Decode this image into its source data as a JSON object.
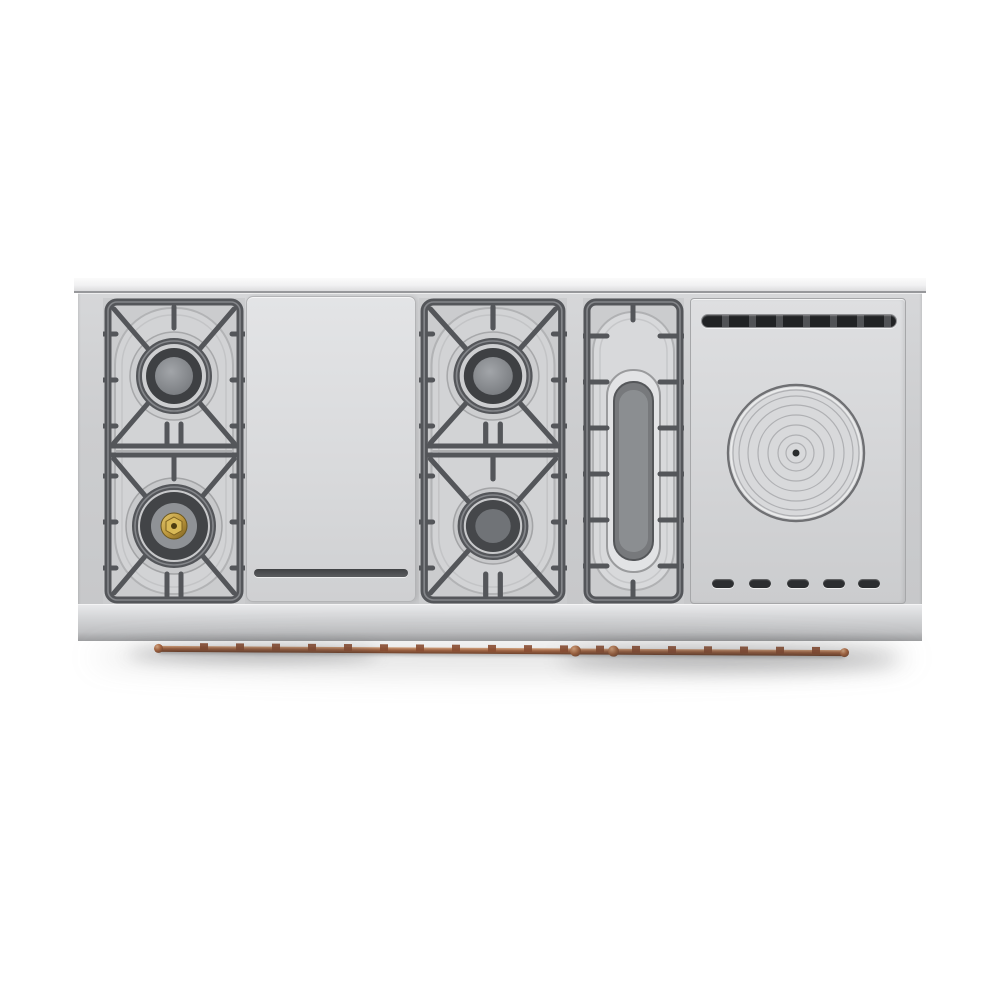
{
  "meta": {
    "description": "Top-down product photograph of a wide stainless steel professional range cooktop on a white background",
    "background_color": "#ffffff"
  },
  "product": {
    "name": "professional-range-cooktop-top-view",
    "finish": "stainless-steel",
    "sections": [
      {
        "id": "left-burner-section",
        "type": "gas-burner-pair-with-cast-iron-grate",
        "burners": [
          {
            "position": "top",
            "style": "standard-gray-cap"
          },
          {
            "position": "bottom",
            "style": "dual-ring-with-brass-center"
          }
        ]
      },
      {
        "id": "griddle",
        "type": "flat-stainless-griddle-plate",
        "features": [
          "front-groove"
        ]
      },
      {
        "id": "middle-burner-section",
        "type": "gas-burner-pair-with-cast-iron-grate",
        "burners": [
          {
            "position": "top",
            "style": "standard-gray-cap"
          },
          {
            "position": "bottom",
            "style": "small-dark-cap"
          }
        ]
      },
      {
        "id": "oval-burner-section",
        "type": "oval-burner-with-cast-iron-grate"
      },
      {
        "id": "french-top",
        "type": "french-top-plate",
        "features": [
          "rear-vent-slot",
          "concentric-ring-disc",
          "center-dot",
          "five-front-slots"
        ],
        "front_slot_count": 5,
        "concentric_ring_count": 7
      }
    ],
    "burner_total_count": 4,
    "towel_rail": {
      "material": "copper",
      "style": "front-mounted-rail-with-clips-and-ball-finials"
    },
    "colors": {
      "stainless_light": "#dedfe1",
      "stainless_mid": "#c9cacc",
      "grate_dark": "#54565a",
      "burner_ring_dark": "#3e4043",
      "burner_cap_gray": "#8e9194",
      "brass": "#c9a84c",
      "copper": "#a35f3a",
      "shadow": "rgba(60,60,62,0.30)"
    }
  }
}
